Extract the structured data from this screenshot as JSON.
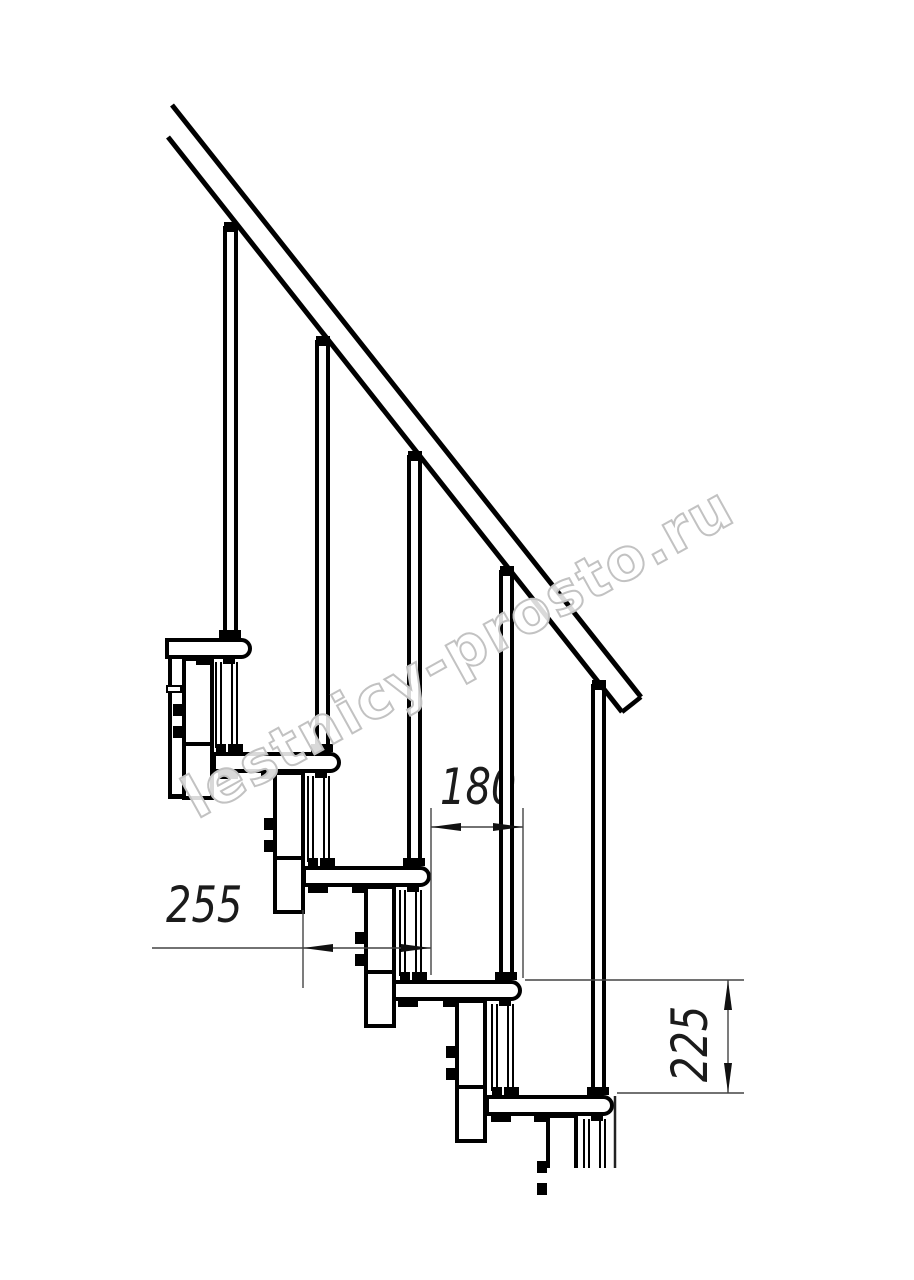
{
  "watermark": {
    "text": "lestnicy-prosto.ru"
  },
  "dimensions": {
    "tread_depth": {
      "value": "255"
    },
    "step_run": {
      "value": "180"
    },
    "riser_height": {
      "value": "225"
    }
  }
}
